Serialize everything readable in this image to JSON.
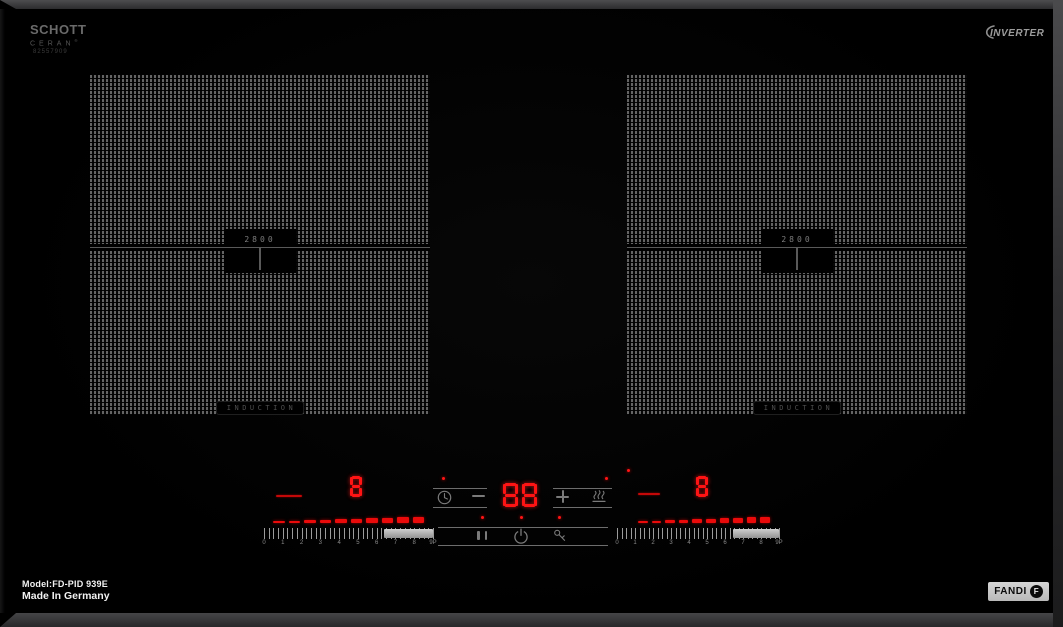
{
  "branding": {
    "schott_line1": "SCHOTT",
    "schott_line2": "CERAN",
    "schott_reg": "®",
    "schott_code": "82557909",
    "inverter_label": "INVERTER",
    "fandi_label": "FANDI",
    "fandi_monogram": "F"
  },
  "zones": {
    "left": {
      "center_power": "2800",
      "type_label": "INDUCTION",
      "level_display": "8"
    },
    "right": {
      "center_power": "2800",
      "type_label": "INDUCTION",
      "level_display": "8"
    }
  },
  "console": {
    "timer_display": "88",
    "icons": [
      "timer-clock-icon",
      "minus-icon",
      "plus-icon",
      "keep-warm-icon",
      "pause-icon",
      "power-icon",
      "key-lock-icon"
    ]
  },
  "sliders": {
    "labels": [
      "0",
      "1",
      "2",
      "3",
      "4",
      "5",
      "6",
      "7",
      "8",
      "9P"
    ],
    "tick_count": 37,
    "dash_count": 10
  },
  "footer": {
    "model": "Model:FD-PID 939E",
    "origin": "Made In Germany"
  },
  "colors": {
    "led_red": "#ff1414",
    "accent_red": "#ea0a0a",
    "pattern_dot": "#646464",
    "panel_line": "#6d6d6d",
    "bar_gray": "#b5b5b5"
  }
}
